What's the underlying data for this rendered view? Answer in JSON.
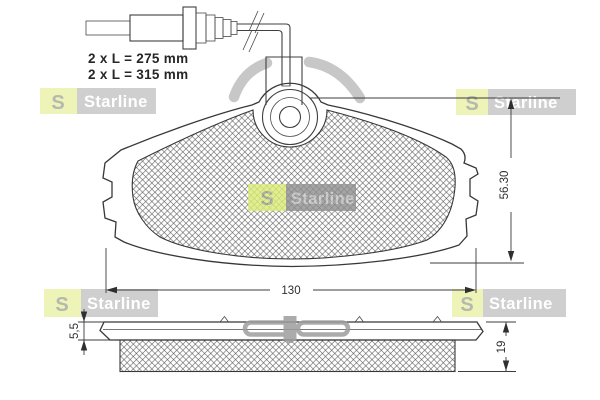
{
  "brand": {
    "name": "Starline",
    "emblem_letter": "S"
  },
  "annotations": {
    "cable_length_1": "2 x L = 275 mm",
    "cable_length_2": "2 x L = 315 mm"
  },
  "dimensions": {
    "pad_width": "130",
    "pad_height": "56.30",
    "backplate_thickness": "5,5",
    "total_thickness": "19"
  },
  "colors": {
    "background": "#ffffff",
    "line": "#3f3f3f",
    "logo_box_gray": "#bfbfbf",
    "logo_box_dark": "#8f8f8f",
    "logo_yellow": "#e9efa0",
    "logo_yellow_center": "#dcec75",
    "clip_gray": "#9d9d9d"
  }
}
